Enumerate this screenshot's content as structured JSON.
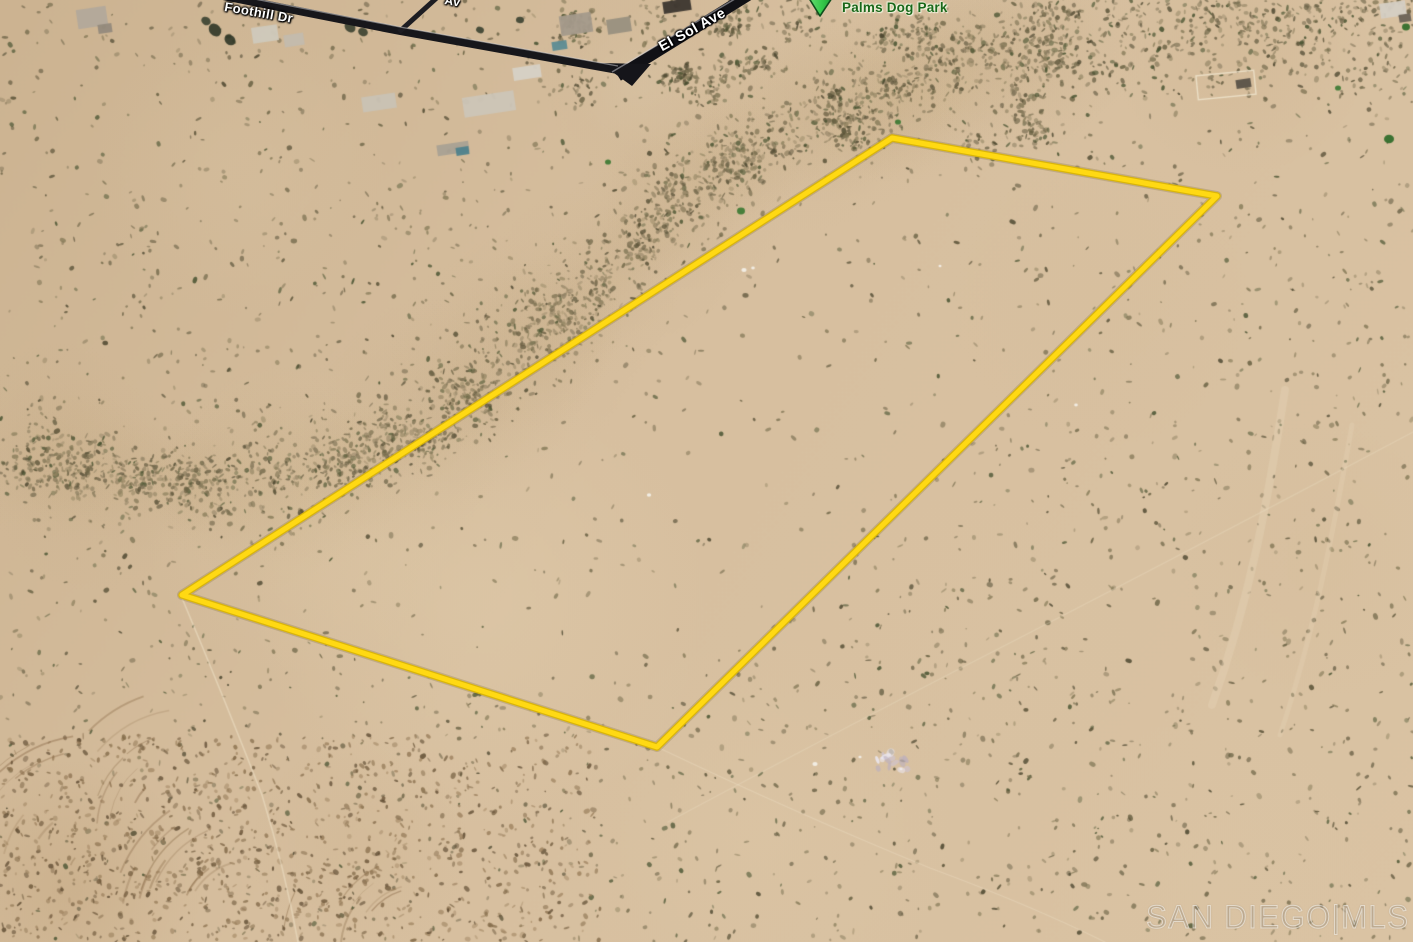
{
  "map": {
    "street_labels": {
      "foothill": "Foothill Dr",
      "el_sol": "El Sol Ave",
      "partial": "Av"
    },
    "park": {
      "name": "Palms Dog Park"
    },
    "parcel": {
      "points": "892,138 1217,196 657,747 182,595",
      "outline_color": "#FFD913"
    },
    "watermark": "SAN DIEGO|MLS",
    "colors": {
      "sand_base": "#D6BF9E",
      "road_dark": "#17171B",
      "park_label_green": "#1A671A",
      "marker_green": "#35C94A"
    }
  }
}
